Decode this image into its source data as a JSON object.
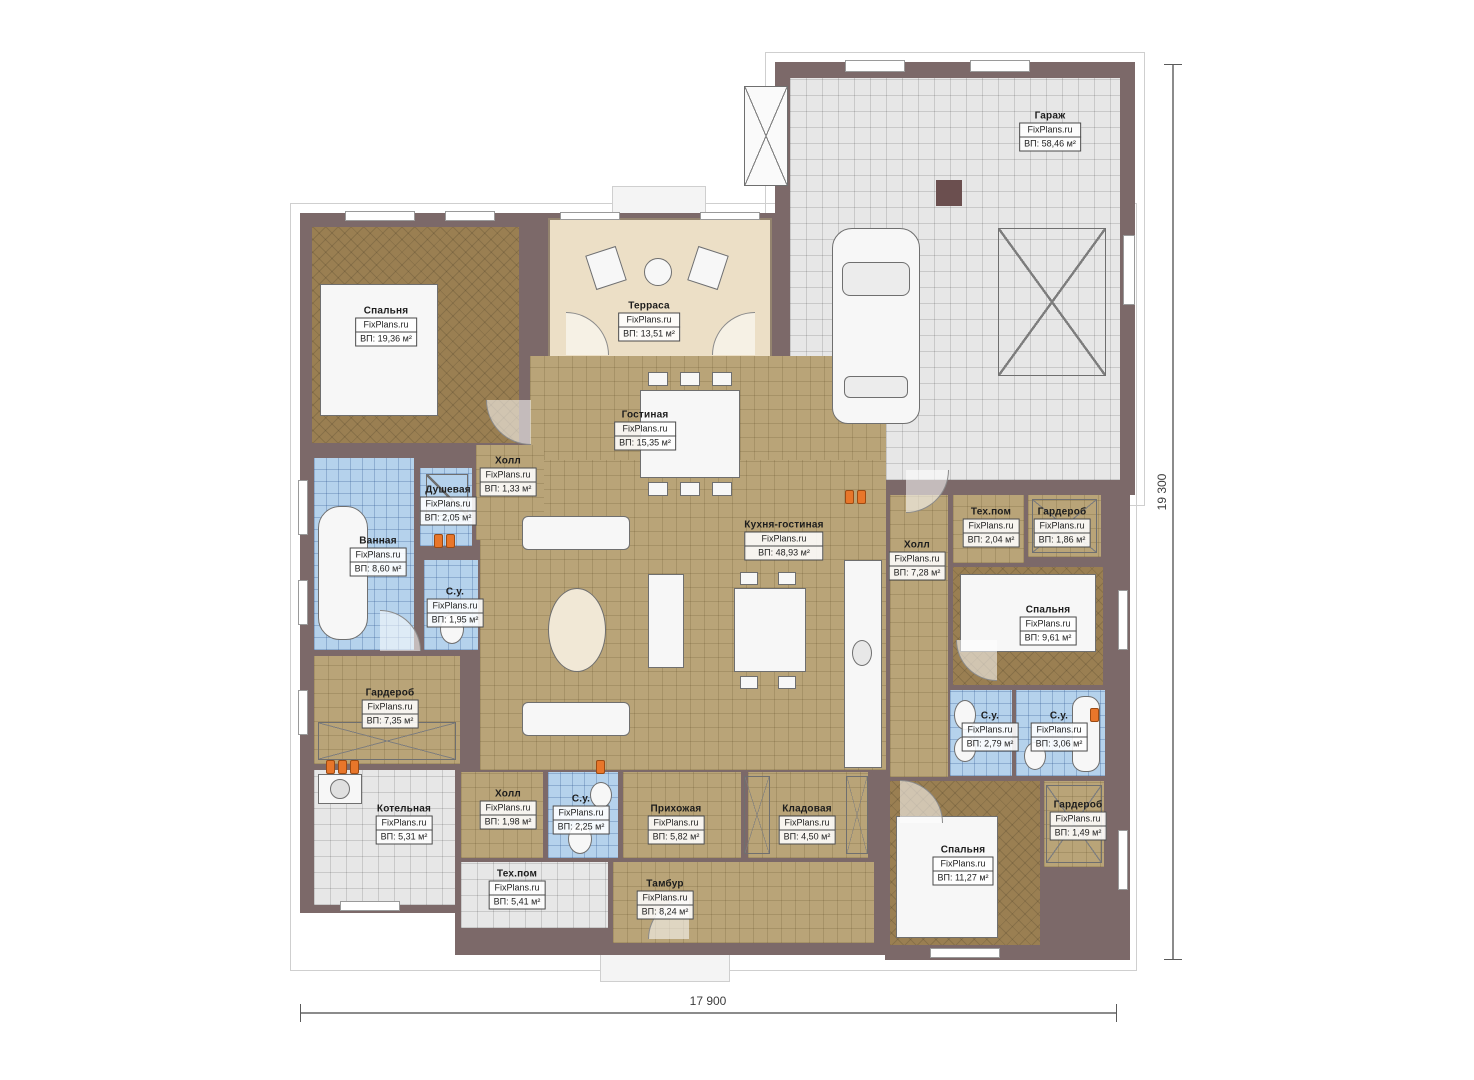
{
  "watermark": {
    "brand": "FixPlans.ru"
  },
  "rooms": [
    {
      "name": "Гараж",
      "area": "ВП: 58,46 м²"
    },
    {
      "name": "Спальня",
      "area": "ВП: 19,36 м²"
    },
    {
      "name": "Терраса",
      "area": "ВП: 13,51 м²"
    },
    {
      "name": "Гостиная",
      "area": "ВП: 15,35 м²"
    },
    {
      "name": "Холл",
      "area": "ВП: 1,33 м²"
    },
    {
      "name": "Душевая",
      "area": "ВП: 2,05 м²"
    },
    {
      "name": "Ванная",
      "area": "ВП: 8,60 м²"
    },
    {
      "name": "С.у.",
      "area": "ВП: 1,95 м²"
    },
    {
      "name": "Кухня-гостиная",
      "area": "ВП: 48,93 м²"
    },
    {
      "name": "Холл",
      "area": "ВП: 7,28 м²"
    },
    {
      "name": "Тех.пом",
      "area": "ВП: 2,04 м²"
    },
    {
      "name": "Гардероб",
      "area": "ВП: 1,86 м²"
    },
    {
      "name": "Спальня",
      "area": "ВП: 9,61 м²"
    },
    {
      "name": "Гардероб",
      "area": "ВП: 7,35 м²"
    },
    {
      "name": "С.у.",
      "area": "ВП: 2,79 м²"
    },
    {
      "name": "С.у.",
      "area": "ВП: 3,06 м²"
    },
    {
      "name": "Котельная",
      "area": "ВП: 5,31 м²"
    },
    {
      "name": "Холл",
      "area": "ВП: 1,98 м²"
    },
    {
      "name": "С.у.",
      "area": "ВП: 2,25 м²"
    },
    {
      "name": "Прихожая",
      "area": "ВП: 5,82 м²"
    },
    {
      "name": "Кладовая",
      "area": "ВП: 4,50 м²"
    },
    {
      "name": "Тех.пом",
      "area": "ВП: 5,41 м²"
    },
    {
      "name": "Тамбур",
      "area": "ВП: 8,24 м²"
    },
    {
      "name": "Спальня",
      "area": "ВП: 11,27 м²"
    },
    {
      "name": "Гардероб",
      "area": "ВП: 1,49 м²"
    }
  ],
  "dimensions": {
    "width": "17 900",
    "height": "19 300"
  },
  "colors": {
    "wall": "#7c6969",
    "floor_tan": "#b9a478",
    "floor_brown": "#9a7f52",
    "floor_blue": "#b5d2ec",
    "floor_grey": "#e7e7e7",
    "terrace": "#ecdfc6",
    "radiator": "#e8762a"
  }
}
